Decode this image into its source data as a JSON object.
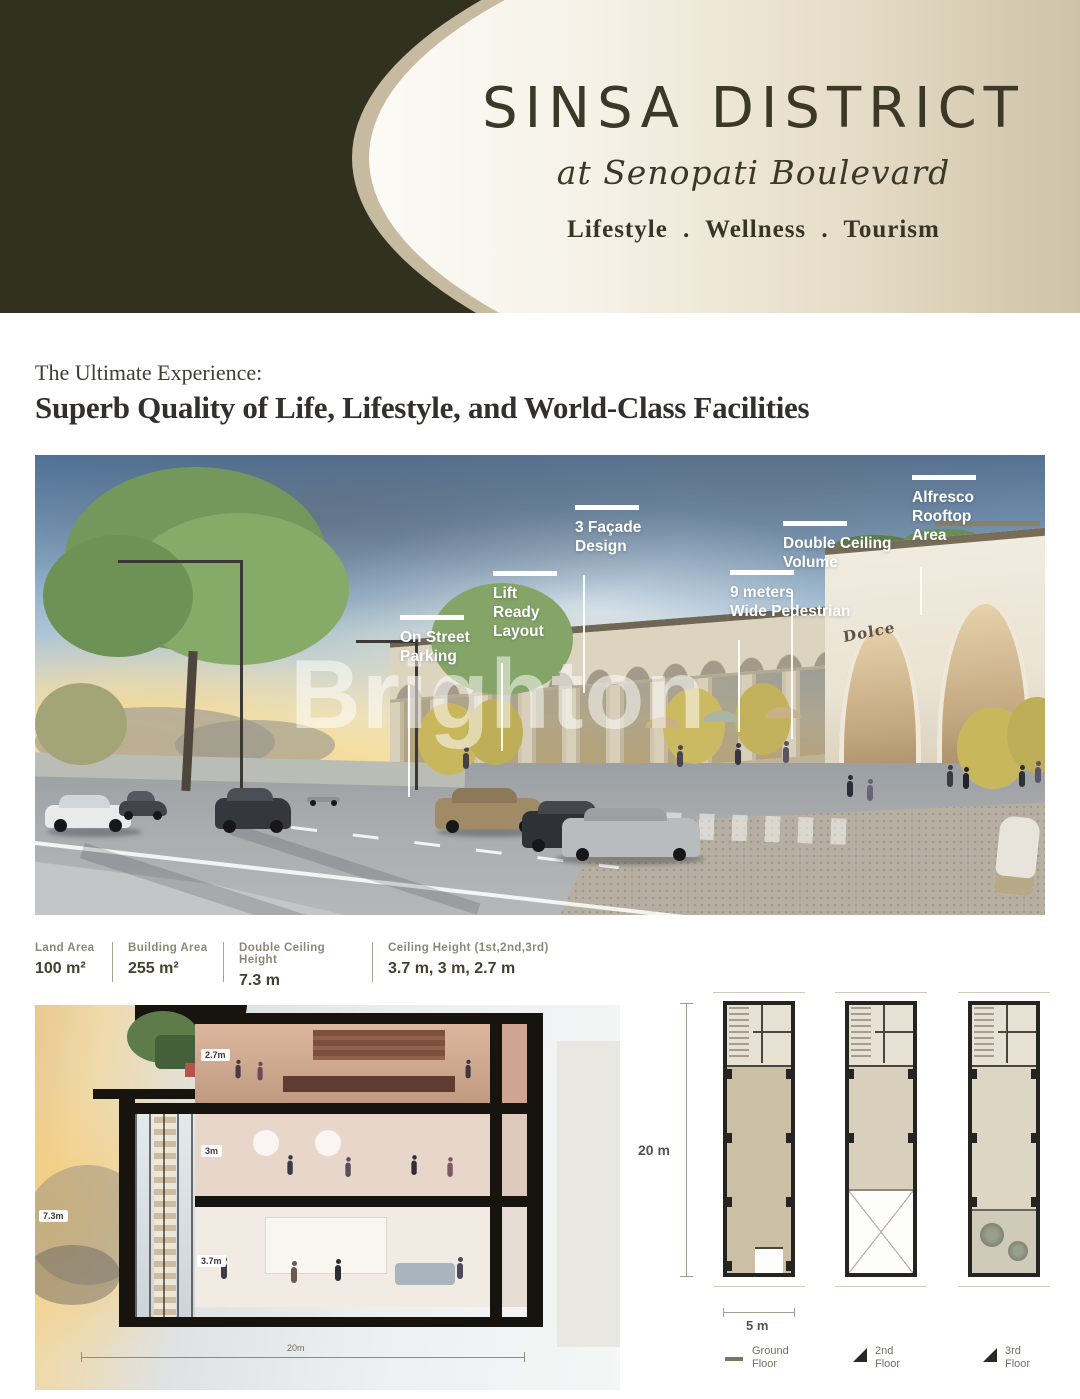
{
  "header": {
    "title": "SINSA DISTRICT",
    "subtitle": "at Senopati Boulevard",
    "tagline": "Lifestyle . Wellness . Tourism"
  },
  "intro": {
    "kicker": "The Ultimate Experience:",
    "headline": "Superb Quality of Life, Lifestyle, and World-Class Facilities"
  },
  "scene": {
    "watermark": "Brighton",
    "storefront_sign": "Dolce",
    "callouts": [
      {
        "id": "on-street-parking",
        "lines": [
          "On Street",
          "Parking"
        ]
      },
      {
        "id": "lift-ready-layout",
        "lines": [
          "Lift",
          "Ready",
          "Layout"
        ]
      },
      {
        "id": "facade-design",
        "lines": [
          "3 Façade",
          "Design"
        ]
      },
      {
        "id": "wide-pedestrian",
        "lines": [
          "9 meters",
          "Wide Pedestrian"
        ]
      },
      {
        "id": "double-ceiling-volume",
        "lines": [
          "Double Ceiling",
          "Volume"
        ]
      },
      {
        "id": "alfresco-rooftop-area",
        "lines": [
          "Alfresco",
          "Rooftop",
          "Area"
        ]
      }
    ]
  },
  "specs": [
    {
      "label": "Land Area",
      "value": "100 m²"
    },
    {
      "label": "Building Area",
      "value": "255 m²"
    },
    {
      "label": "Double Ceiling Height",
      "value": "7.3 m"
    },
    {
      "label": "Ceiling Height (1st,2nd,3rd)",
      "value": "3.7 m, 3 m, 2.7 m"
    }
  ],
  "section_view": {
    "dims": {
      "third_floor": "2.7m",
      "second_floor": "3m",
      "first_floor": "3.7m",
      "double_ceiling": "7.3m",
      "depth": "20m"
    }
  },
  "floor_plans": {
    "height_label": "20 m",
    "width_label": "5 m",
    "legend": [
      {
        "icon": "dash",
        "lines": [
          "Ground",
          "Floor"
        ]
      },
      {
        "icon": "triangle",
        "lines": [
          "2nd",
          "Floor"
        ]
      },
      {
        "icon": "triangle",
        "lines": [
          "3rd",
          "Floor"
        ]
      }
    ]
  },
  "colors": {
    "dark_olive": "#32301F",
    "tan": "#C9BDA3",
    "cream": "#F9F7F1",
    "text_dark": "#3B3828"
  }
}
